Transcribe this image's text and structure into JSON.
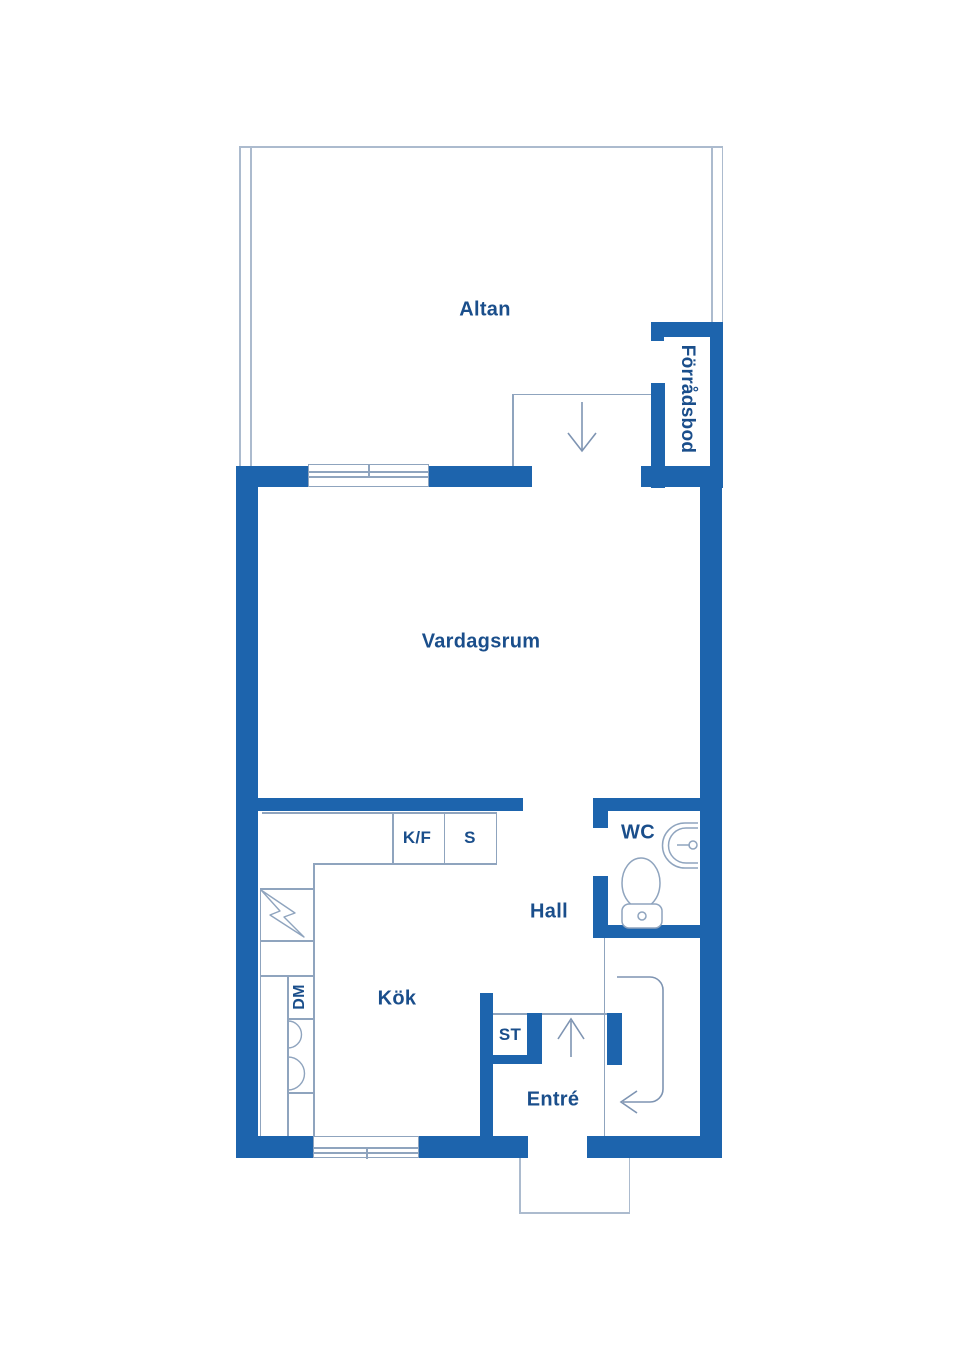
{
  "floorplan": {
    "rooms": {
      "altan": "Altan",
      "forradsbod": "Förrådsbod",
      "vardagsrum": "Vardagsrum",
      "kok": "Kök",
      "hall": "Hall",
      "wc": "WC",
      "entre": "Entré"
    },
    "fixtures": {
      "kf": "K/F",
      "s": "S",
      "st": "ST",
      "dm": "DM"
    },
    "icons": {
      "terrace_door_arrow": "down-arrow",
      "entrance_arrow": "up-arrow",
      "entrance_path_arrow": "curved-left-arrow",
      "electric_symbol": "lightning-bolt",
      "toilet": "toilet-outline",
      "wash_basin": "half-round-basin-with-tap",
      "kitchen_basins": "two-half-circle-arcs",
      "windows": "multi-line-window-symbol"
    },
    "colors": {
      "wall": "#1D64AD",
      "label": "#1A4E8B",
      "line": "#8FA4BE",
      "line_light": "#ACBBCE",
      "arrow": "#7E94B2",
      "background": "#FFFFFF"
    }
  }
}
